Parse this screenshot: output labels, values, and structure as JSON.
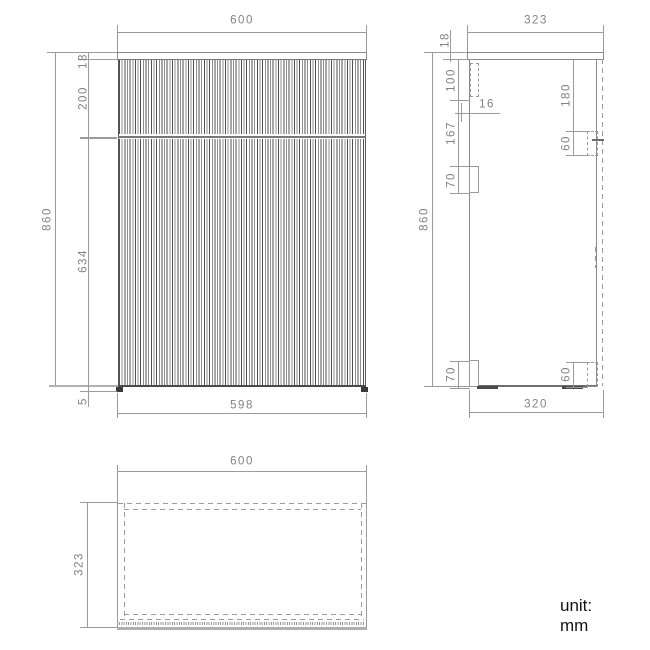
{
  "unit_label": "unit: mm",
  "front_view": {
    "width_top": "600",
    "width_bottom": "598",
    "height_total": "860",
    "top_thickness": "18",
    "drawer_front_height": "200",
    "door_height": "634",
    "plinth_gap": "5"
  },
  "side_view": {
    "depth_top": "323",
    "depth_bottom": "320",
    "height_total": "860",
    "top_thickness": "18",
    "hinge_top_offset": "100",
    "hinge_plate": "16",
    "hinge_spacing": "167",
    "hinge_block_height": "70",
    "bracket_offset": "180",
    "bracket_height": "60",
    "bottom_block_height": "70",
    "bottom_bracket_height": "60"
  },
  "top_view": {
    "width": "600",
    "depth": "323"
  }
}
